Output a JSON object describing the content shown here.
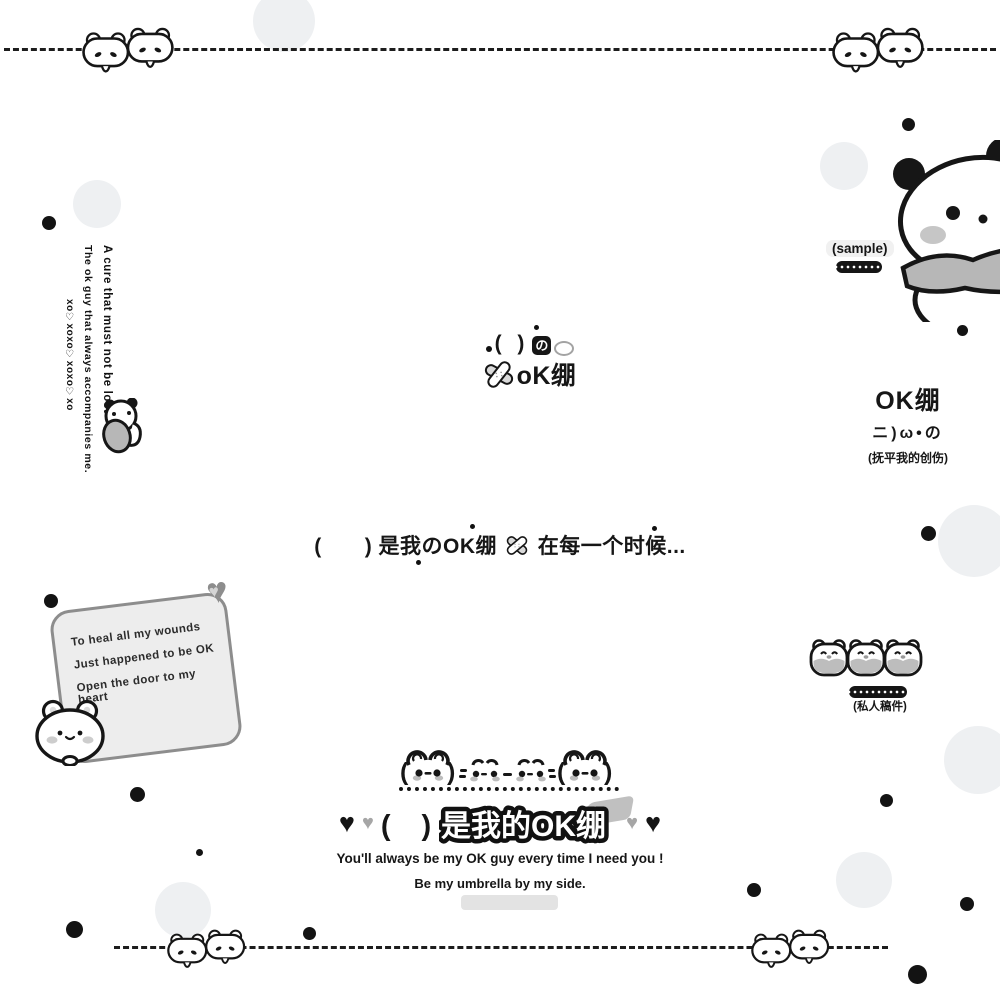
{
  "icons": {
    "heart": "♥"
  },
  "left_vertical": {
    "line1": "A cure that must not be lost",
    "line2": "The ok guy that always accompanies me.",
    "line3": "xo♡xoxo♡xoxo♡xo"
  },
  "sample_tag": {
    "label": "(sample)"
  },
  "center_logo": {
    "paren": "(  )",
    "no_char": "の",
    "ok_label": "oK绷"
  },
  "right_block": {
    "title": "OK绷",
    "icon_row": "ニ)ω•の",
    "caption": "(抚平我的创伤)"
  },
  "middle_line": {
    "part1": "(　　) 是我のOK绷",
    "part2": "在每一个时候..."
  },
  "note_card": {
    "lines": [
      "To heal all my wounds",
      "Just happened to be OK",
      "Open the door to my heart"
    ]
  },
  "bear_trio": {
    "caption": "(私人稿件)"
  },
  "title_block": {
    "paren": "(　)",
    "title": "是我的OK绷",
    "subtitle1": "You'll always be my OK guy every time I need you !",
    "subtitle2": "Be my umbrella by my side."
  }
}
